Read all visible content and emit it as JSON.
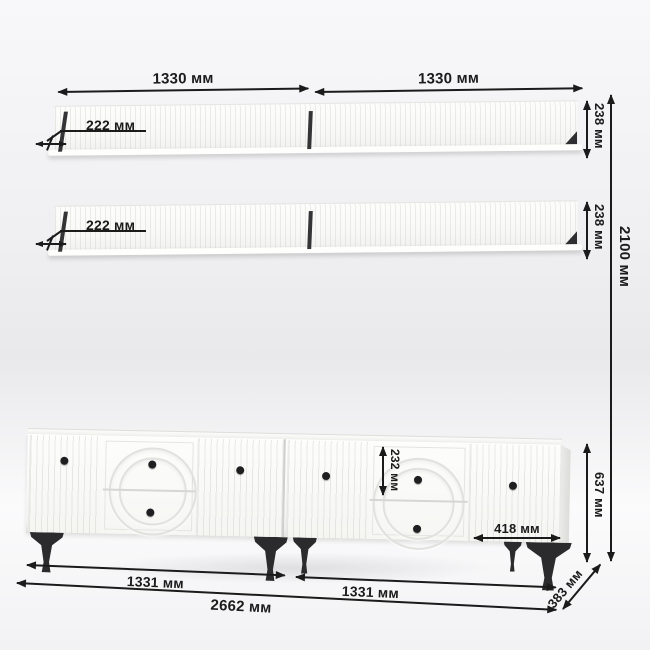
{
  "diagram": {
    "kind": "furniture dimension drawing",
    "units": "мм"
  },
  "dims": {
    "shelf_width_left": "1330 мм",
    "shelf_width_right": "1330 мм",
    "shelf1_depth": "222 мм",
    "shelf1_height": "238 мм",
    "shelf2_depth": "222 мм",
    "shelf2_height": "238 мм",
    "total_height": "2100 мм",
    "drawer_height": "232 мм",
    "door_width": "418 мм",
    "cabinet_height": "637 мм",
    "cabinet_width_left": "1331 мм",
    "cabinet_width_right": "1331 мм",
    "cabinet_total_width": "2662 мм",
    "cabinet_depth": "383 мм"
  },
  "colors": {
    "dimension_lines": "#1b1b1b",
    "furniture_body": "#fbfbfa",
    "legs_and_knobs": "#2b2b2d",
    "background_top": "#f8f8fa",
    "background_mid": "#e9e9eb"
  }
}
